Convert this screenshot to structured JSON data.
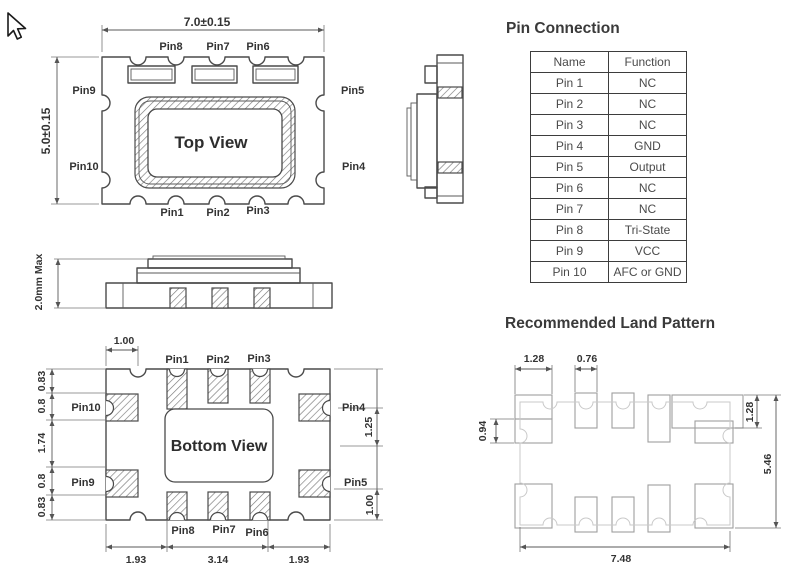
{
  "titles": {
    "pin_connection": "Pin Connection",
    "land_pattern": "Recommended Land Pattern"
  },
  "top_view": {
    "label": "Top View",
    "dims": {
      "width": "7.0±0.15",
      "height": "5.0±0.15"
    },
    "pins": {
      "top": [
        "Pin8",
        "Pin7",
        "Pin6"
      ],
      "left_upper": "Pin9",
      "left_lower": "Pin10",
      "right_upper": "Pin5",
      "right_lower": "Pin4",
      "bottom": [
        "Pin1",
        "Pin2",
        "Pin3"
      ]
    }
  },
  "side_profile": {
    "dim_height": "2.0mm Max"
  },
  "bottom_view": {
    "label": "Bottom View",
    "dims": {
      "pad_offset": "1.00",
      "left": [
        "0.83",
        "0.8",
        "1.74",
        "0.8",
        "0.83"
      ],
      "right_upper": "1.25",
      "right_lower": "1.00",
      "bottom": [
        "1.93",
        "3.14",
        "1.93"
      ]
    },
    "pins": {
      "top": [
        "Pin1",
        "Pin2",
        "Pin3"
      ],
      "left_upper": "Pin10",
      "left_lower": "Pin9",
      "right_upper": "Pin4",
      "right_lower": "Pin5",
      "bottom": [
        "Pin8",
        "Pin7",
        "Pin6"
      ]
    }
  },
  "pin_table": {
    "headers": [
      "Name",
      "Function"
    ],
    "rows": [
      [
        "Pin 1",
        "NC"
      ],
      [
        "Pin 2",
        "NC"
      ],
      [
        "Pin 3",
        "NC"
      ],
      [
        "Pin 4",
        "GND"
      ],
      [
        "Pin 5",
        "Output"
      ],
      [
        "Pin 6",
        "NC"
      ],
      [
        "Pin 7",
        "NC"
      ],
      [
        "Pin 8",
        "Tri-State"
      ],
      [
        "Pin 9",
        "VCC"
      ],
      [
        "Pin 10",
        "AFC or GND"
      ]
    ]
  },
  "land_pattern": {
    "dims": {
      "corner_pad_width": "1.28",
      "center_pad_width": "0.76",
      "side_pad_height": "0.94",
      "right_pad_height": "1.28",
      "overall_height": "5.46",
      "overall_width": "7.48"
    }
  }
}
